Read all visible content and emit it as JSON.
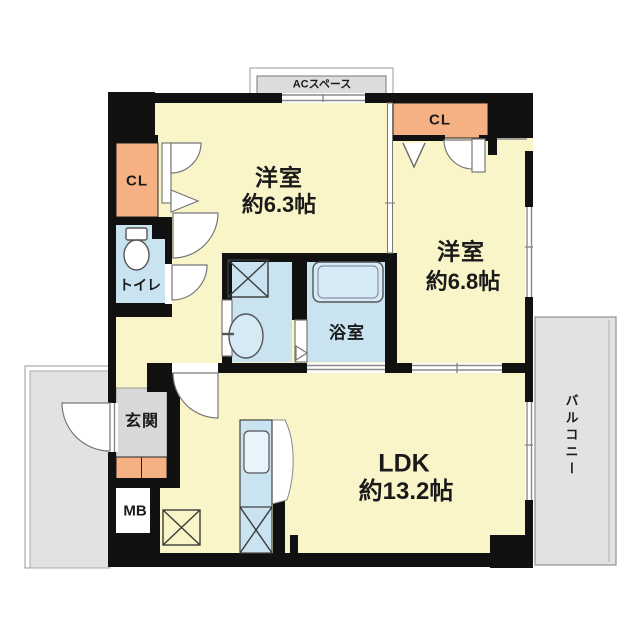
{
  "title": "マンション間取り図 2LDK",
  "labels": {
    "ac_space": "ACスペース",
    "closet1": "CL",
    "closet2": "CL",
    "room1_name": "洋室",
    "room1_size": "約6.3帖",
    "room2_name": "洋室",
    "room2_size": "約6.8帖",
    "toilet": "トイレ",
    "bathroom": "浴室",
    "genkan": "玄関",
    "mb": "MB",
    "ldk_name": "LDK",
    "ldk_size": "約13.2帖",
    "balcony": "バルコニー"
  },
  "colors": {
    "room_floor": "#FAF5C8",
    "closet": "#F5B183",
    "wet_area": "#C9E3F1",
    "genkan_floor": "#D8D8D8",
    "outdoor": "#E2E2E2",
    "wall": "#111111"
  }
}
